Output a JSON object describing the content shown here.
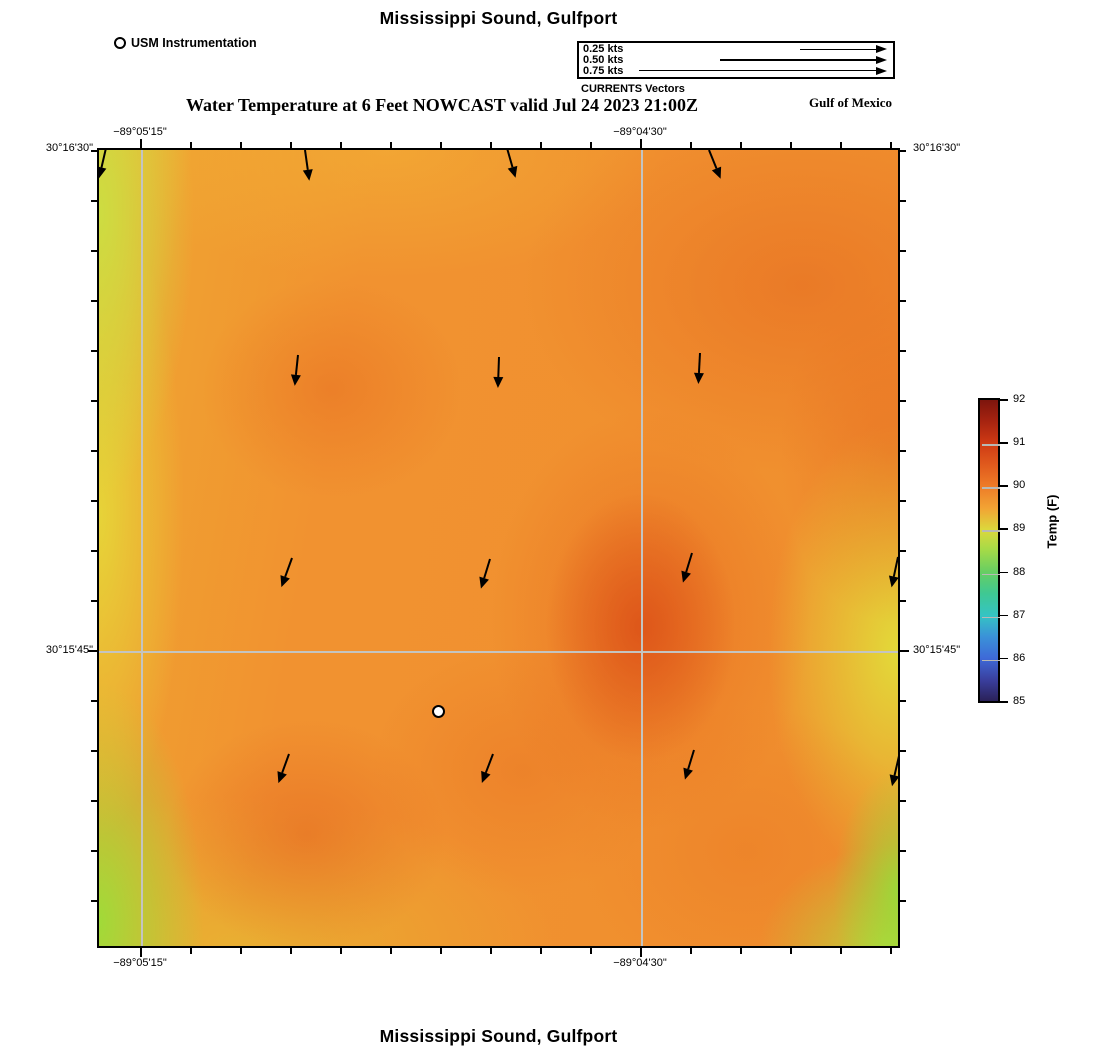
{
  "titles": {
    "top": "Mississippi Sound, Gulfport",
    "subtitle": "Water Temperature at 6 Feet NOWCAST valid Jul 24 2023 21:00Z",
    "bottom": "Mississippi Sound, Gulfport",
    "gulf": "Gulf of Mexico"
  },
  "instrumentation_legend": {
    "label": "USM Instrumentation"
  },
  "currents_legend": {
    "caption": "CURRENTS Vectors",
    "items": [
      {
        "label": "0.25 kts",
        "speed_kts": 0.25
      },
      {
        "label": "0.50 kts",
        "speed_kts": 0.5
      },
      {
        "label": "0.75 kts",
        "speed_kts": 0.75
      }
    ]
  },
  "axes": {
    "lon_labels": [
      {
        "text": "−89°05'15\"",
        "x_px": 43
      },
      {
        "text": "−89°04'30\"",
        "x_px": 543
      }
    ],
    "lat_labels": [
      {
        "text": "30°16'30\"",
        "y_px": 0
      },
      {
        "text": "30°15'45\"",
        "y_px": 502
      }
    ]
  },
  "colorbar": {
    "title": "Temp (F)",
    "tick_labels": [
      "92",
      "91",
      "90",
      "89",
      "88",
      "87",
      "86",
      "85"
    ],
    "min": 85,
    "max": 92,
    "gradient_stops": [
      {
        "pos": 0,
        "color": "#7d150d"
      },
      {
        "pos": 7,
        "color": "#a62310"
      },
      {
        "pos": 14.3,
        "color": "#ce3a14"
      },
      {
        "pos": 21.5,
        "color": "#e05a1d"
      },
      {
        "pos": 28.6,
        "color": "#ee7b27"
      },
      {
        "pos": 36,
        "color": "#f2a434"
      },
      {
        "pos": 43,
        "color": "#dcd83c"
      },
      {
        "pos": 50,
        "color": "#a3da48"
      },
      {
        "pos": 57.2,
        "color": "#66ce63"
      },
      {
        "pos": 64.3,
        "color": "#3fc893"
      },
      {
        "pos": 71.5,
        "color": "#35c4c3"
      },
      {
        "pos": 78.6,
        "color": "#3a92d8"
      },
      {
        "pos": 85.7,
        "color": "#3e6ad8"
      },
      {
        "pos": 93,
        "color": "#3a3f9e"
      },
      {
        "pos": 100,
        "color": "#2a2158"
      }
    ]
  },
  "map": {
    "layout": {
      "width": 803,
      "height": 800,
      "minor_tick_step": 50,
      "top_tick_start": 43,
      "side_tick_start": 2,
      "lon_major_px": [
        43,
        543
      ],
      "lat_major_px": [
        0,
        502
      ],
      "gridline_color": "#c4c4c0"
    },
    "vectors": [
      {
        "x": 7,
        "y": -2,
        "rot": 13
      },
      {
        "x": 206,
        "y": 0,
        "rot": -8
      },
      {
        "x": 408,
        "y": -2,
        "rot": -16
      },
      {
        "x": 610,
        "y": 0,
        "rot": -22
      },
      {
        "x": 199,
        "y": 205,
        "rot": 6
      },
      {
        "x": 400,
        "y": 207,
        "rot": 2
      },
      {
        "x": 601,
        "y": 203,
        "rot": 3
      },
      {
        "x": 193,
        "y": 408,
        "rot": 20
      },
      {
        "x": 391,
        "y": 409,
        "rot": 17
      },
      {
        "x": 593,
        "y": 403,
        "rot": 17
      },
      {
        "x": 799,
        "y": 407,
        "rot": 12
      },
      {
        "x": 190,
        "y": 604,
        "rot": 20
      },
      {
        "x": 394,
        "y": 604,
        "rot": 21
      },
      {
        "x": 595,
        "y": 600,
        "rot": 17
      },
      {
        "x": 800,
        "y": 606,
        "rot": 13
      }
    ],
    "station": {
      "x": 340,
      "y": 562,
      "label": "USM Instrumentation"
    }
  },
  "chart_data": {
    "type": "heatmap",
    "title": "Mississippi Sound, Gulfport",
    "subtitle": "Water Temperature at 6 Feet NOWCAST valid Jul 24 2023 21:00Z",
    "region_label": "Gulf of Mexico",
    "colorbar": {
      "label": "Temp (F)",
      "range": [
        85,
        92
      ],
      "ticks": [
        92,
        91,
        90,
        89,
        88,
        87,
        86,
        85
      ]
    },
    "x_axis": {
      "type": "longitude",
      "tick_labels": [
        "−89°05'15\"",
        "−89°04'30\""
      ],
      "shown_on": "top and bottom"
    },
    "y_axis": {
      "type": "latitude",
      "tick_labels": [
        "30°16'30\"",
        "30°15'45\""
      ],
      "shown_on": "left and right"
    },
    "temperature_grid_F": {
      "note": "approximate values read from the color field; rows top to bottom, columns left to right",
      "values": [
        [
          89.2,
          90.1,
          90.3,
          90.6,
          90.6
        ],
        [
          89.0,
          90.3,
          90.4,
          90.8,
          89.6
        ],
        [
          89.0,
          90.3,
          91.0,
          90.6,
          89.2
        ],
        [
          88.9,
          90.4,
          90.5,
          90.3,
          88.7
        ]
      ]
    },
    "current_vectors": {
      "reference_speeds_kts": [
        0.25,
        0.5,
        0.75
      ],
      "approx_speed_kts": 0.1,
      "direction": "southward in the north, veering to south-southwest in the south half",
      "count": 15
    },
    "station_marker": {
      "label": "USM Instrumentation",
      "present": true
    }
  }
}
